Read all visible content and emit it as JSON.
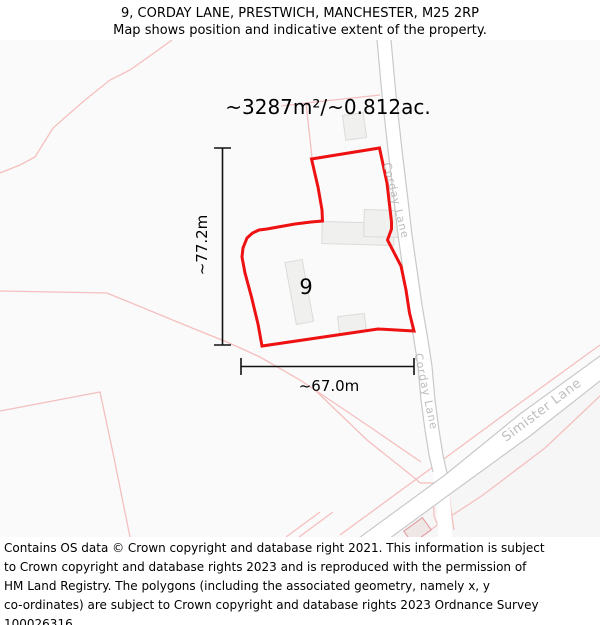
{
  "header": {
    "line1": "9, CORDAY LANE, PRESTWICH, MANCHESTER, M25 2RP",
    "line2": "Map shows position and indicative extent of the property."
  },
  "map": {
    "area_label": "~3287m²/~0.812ac.",
    "vertical_measure": "~77.2m",
    "horizontal_measure": "~67.0m",
    "plot_number": "9",
    "roads": {
      "corday_upper": "Corday Lane",
      "corday_lower": "Corday Lane",
      "simister": "Simister Lane"
    },
    "colors": {
      "boundary": "#ee1111",
      "parcel_line": "#f5bfbf",
      "road_edge": "#c9c9c9",
      "road_fill": "#ffffff",
      "road_label": "#bdbdbd",
      "building_fill": "#f0f0ee",
      "building_stroke": "#dbdbd9",
      "pink_building_fill": "#efe6e6",
      "pink_building_stroke": "#e2a3a3",
      "map_bg": "#fafafa",
      "measure_line": "#111111"
    }
  },
  "footer": {
    "lines": [
      "Contains OS data © Crown copyright and database right 2021. This information is subject",
      "to Crown copyright and database rights 2023 and is reproduced with the permission of",
      "HM Land Registry. The polygons (including the associated geometry, namely x, y",
      "co-ordinates) are subject to Crown copyright and database rights 2023 Ordnance Survey",
      "100026316."
    ]
  }
}
